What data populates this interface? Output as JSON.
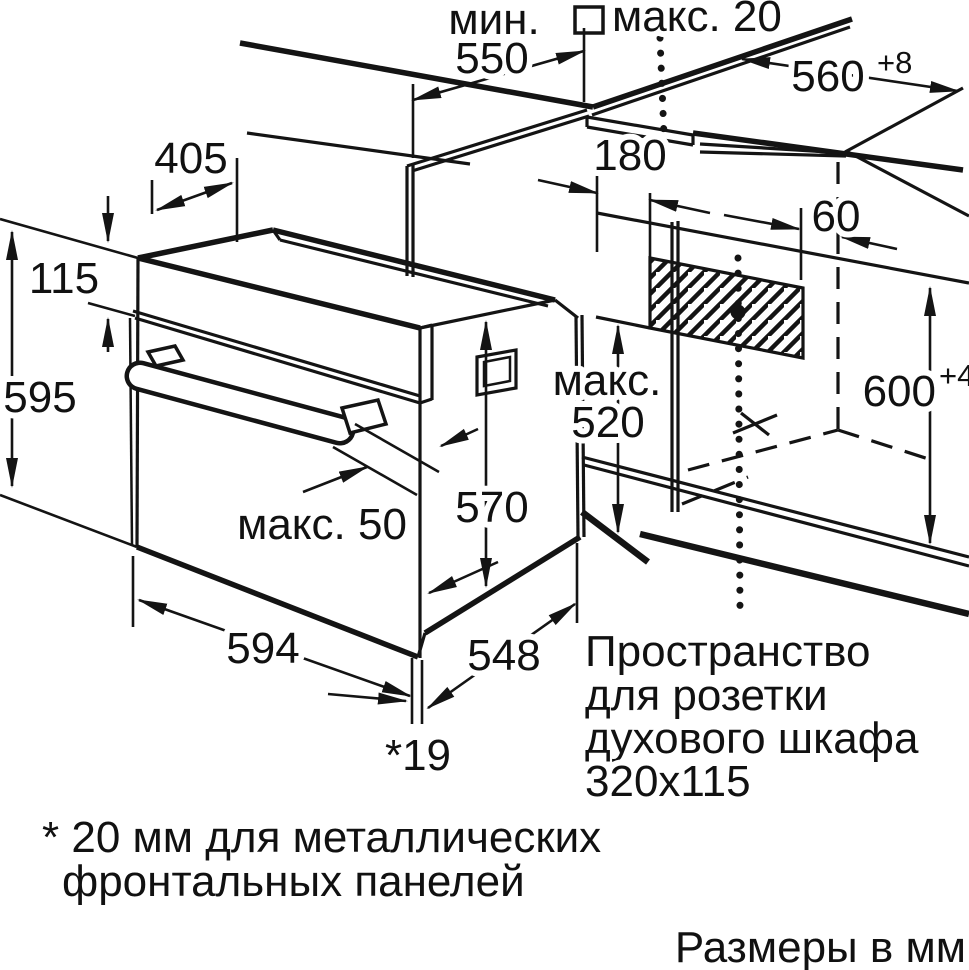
{
  "diagram": {
    "units_note": "Размеры в мм",
    "footnote": {
      "line1": "* 20 мм для металлических",
      "line2": "фронтальных панелей"
    },
    "socket_note": {
      "line1": "Пространство",
      "line2": "для розетки",
      "line3": "духового шкафа",
      "line4": "320x115"
    },
    "dims": {
      "min_550_word": "мин.",
      "min_550_value": "550",
      "max_20": "макс. 20",
      "niche_depth": "560",
      "niche_depth_tol": "+8",
      "top_depth": "405",
      "panel_height": "115",
      "oven_height": "595",
      "socket_offset_left": "180",
      "socket_offset_back": "60",
      "niche_height": "600",
      "niche_height_tol": "+4",
      "max_520_word": "макс.",
      "max_520_value": "520",
      "body_height": "570",
      "handle_max": "макс. 50",
      "oven_width": "594",
      "body_depth": "548",
      "front_gap": "*19"
    }
  },
  "colors": {
    "ink": "#141414",
    "background": "#ffffff"
  }
}
